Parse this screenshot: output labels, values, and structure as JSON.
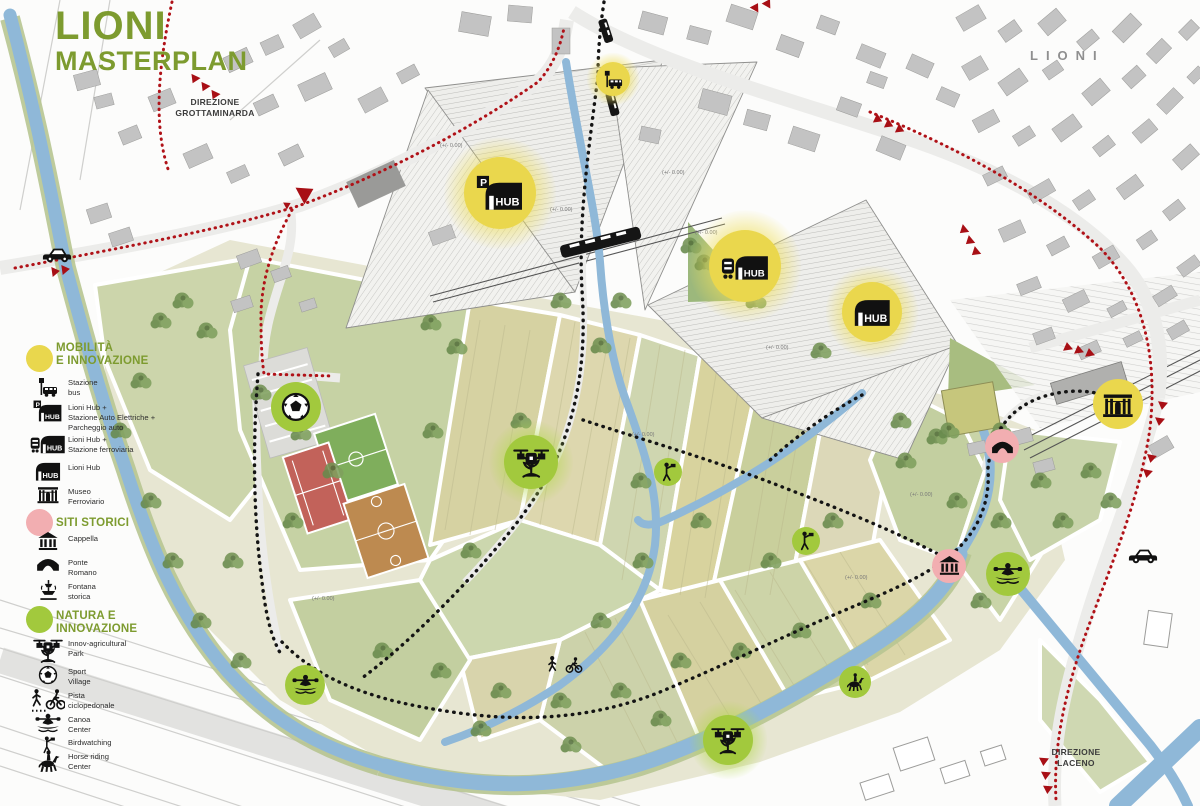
{
  "title": {
    "line1": "LIONI",
    "line2": "MASTERPLAN"
  },
  "labels": {
    "direzione_grottaminarda": "DIREZIONE\nGROTTAMINARDA",
    "town_name": "LIONI",
    "direzione_laceno": "DIREZIONE\nLACENO",
    "elevation_mark": "(+/- 0.00)"
  },
  "hub_label": "HUB",
  "colors": {
    "title_green": "#7d9b2f",
    "legend_yellow": "#e9d74d",
    "legend_pink": "#f2aeb1",
    "legend_green": "#a2c93d",
    "route_red": "#b01218",
    "path_black": "#141414",
    "river_blue": "#8fb8d8",
    "building_gray": "#c3c3c3"
  },
  "legend": {
    "sections": [
      {
        "title": "MOBILITÀ\nE INNOVAZIONE",
        "dot_color": "#e9d74d",
        "items": [
          {
            "icon": "bus-stop-icon",
            "label": "Stazione\nbus"
          },
          {
            "icon": "hub-parking-icon",
            "label": "Lioni Hub +\nStazione Auto Elettriche +\nParcheggio auto"
          },
          {
            "icon": "hub-rail-icon",
            "label": "Lioni Hub +\nStazione ferroviaria"
          },
          {
            "icon": "hub-icon",
            "label": "Lioni Hub"
          },
          {
            "icon": "museum-icon",
            "label": "Museo\nFerroviario"
          }
        ]
      },
      {
        "title": "SITI STORICI",
        "dot_color": "#f2aeb1",
        "items": [
          {
            "icon": "temple-icon",
            "label": "Cappella"
          },
          {
            "icon": "bridge-icon",
            "label": "Ponte\nRomano"
          },
          {
            "icon": "fountain-icon",
            "label": "Fontana\nstorica"
          }
        ]
      },
      {
        "title": "NATURA E\nINNOVAZIONE",
        "dot_color": "#a2c93d",
        "items": [
          {
            "icon": "drone-agri-icon",
            "label": "Innov-agricultural\nPark"
          },
          {
            "icon": "sport-icon",
            "label": "Sport\nVillage"
          },
          {
            "icon": "bike-walk-icon",
            "label": "Pista\nciclopedonale"
          },
          {
            "icon": "canoe-icon",
            "label": "Canoa\nCenter"
          },
          {
            "icon": "birdwatching-icon",
            "label": "Birdwatching"
          },
          {
            "icon": "horse-icon",
            "label": "Horse riding\nCenter"
          }
        ]
      }
    ]
  },
  "markers": [
    {
      "name": "marker-stazione-bus",
      "kind": "yellow",
      "icon": "bus-stop-icon",
      "x": 613,
      "y": 79,
      "r": 17,
      "glow": true
    },
    {
      "name": "marker-lioni-hub-parcheggio",
      "kind": "yellow",
      "icon": "hub-parking-icon",
      "x": 500,
      "y": 193,
      "r": 36,
      "glow": true
    },
    {
      "name": "marker-lioni-hub-ferroviaria",
      "kind": "yellow",
      "icon": "hub-rail-icon",
      "x": 745,
      "y": 266,
      "r": 36,
      "glow": true
    },
    {
      "name": "marker-lioni-hub",
      "kind": "yellow",
      "icon": "hub-icon",
      "x": 872,
      "y": 312,
      "r": 30,
      "glow": true
    },
    {
      "name": "marker-museo-ferroviario",
      "kind": "yellow",
      "icon": "museum-icon",
      "x": 1118,
      "y": 404,
      "r": 25,
      "glow": false
    },
    {
      "name": "marker-ponte-romano",
      "kind": "pink",
      "icon": "bridge-icon",
      "x": 1002,
      "y": 446,
      "r": 17,
      "glow": false
    },
    {
      "name": "marker-cappella",
      "kind": "pink",
      "icon": "temple-icon",
      "x": 949,
      "y": 566,
      "r": 17,
      "glow": false
    },
    {
      "name": "marker-sport-village",
      "kind": "green",
      "icon": "sport-icon",
      "x": 296,
      "y": 407,
      "r": 25,
      "glow": false
    },
    {
      "name": "marker-innov-agricultural-park-1",
      "kind": "green",
      "icon": "drone-agri-icon",
      "x": 531,
      "y": 462,
      "r": 27,
      "glow": true
    },
    {
      "name": "marker-birdwatching-1",
      "kind": "green",
      "icon": "birdwatching-icon",
      "x": 668,
      "y": 472,
      "r": 14,
      "glow": false
    },
    {
      "name": "marker-birdwatching-2",
      "kind": "green",
      "icon": "birdwatching-icon",
      "x": 806,
      "y": 541,
      "r": 14,
      "glow": false
    },
    {
      "name": "marker-canoa-center-1",
      "kind": "green",
      "icon": "canoe-icon",
      "x": 305,
      "y": 685,
      "r": 20,
      "glow": false
    },
    {
      "name": "marker-canoa-center-2",
      "kind": "green",
      "icon": "canoe-icon",
      "x": 1008,
      "y": 574,
      "r": 22,
      "glow": false
    },
    {
      "name": "marker-horse-riding-center",
      "kind": "green",
      "icon": "horse-icon",
      "x": 855,
      "y": 682,
      "r": 16,
      "glow": false
    },
    {
      "name": "marker-innov-agricultural-park-2",
      "kind": "green",
      "icon": "drone-agri-icon",
      "x": 728,
      "y": 740,
      "r": 25,
      "glow": true
    },
    {
      "name": "marker-car-route-west",
      "kind": "plain",
      "icon": "car-icon",
      "x": 57,
      "y": 252,
      "r": 16,
      "glow": false
    },
    {
      "name": "marker-car-route-east",
      "kind": "plain",
      "icon": "car-icon",
      "x": 1143,
      "y": 553,
      "r": 16,
      "glow": false
    }
  ]
}
